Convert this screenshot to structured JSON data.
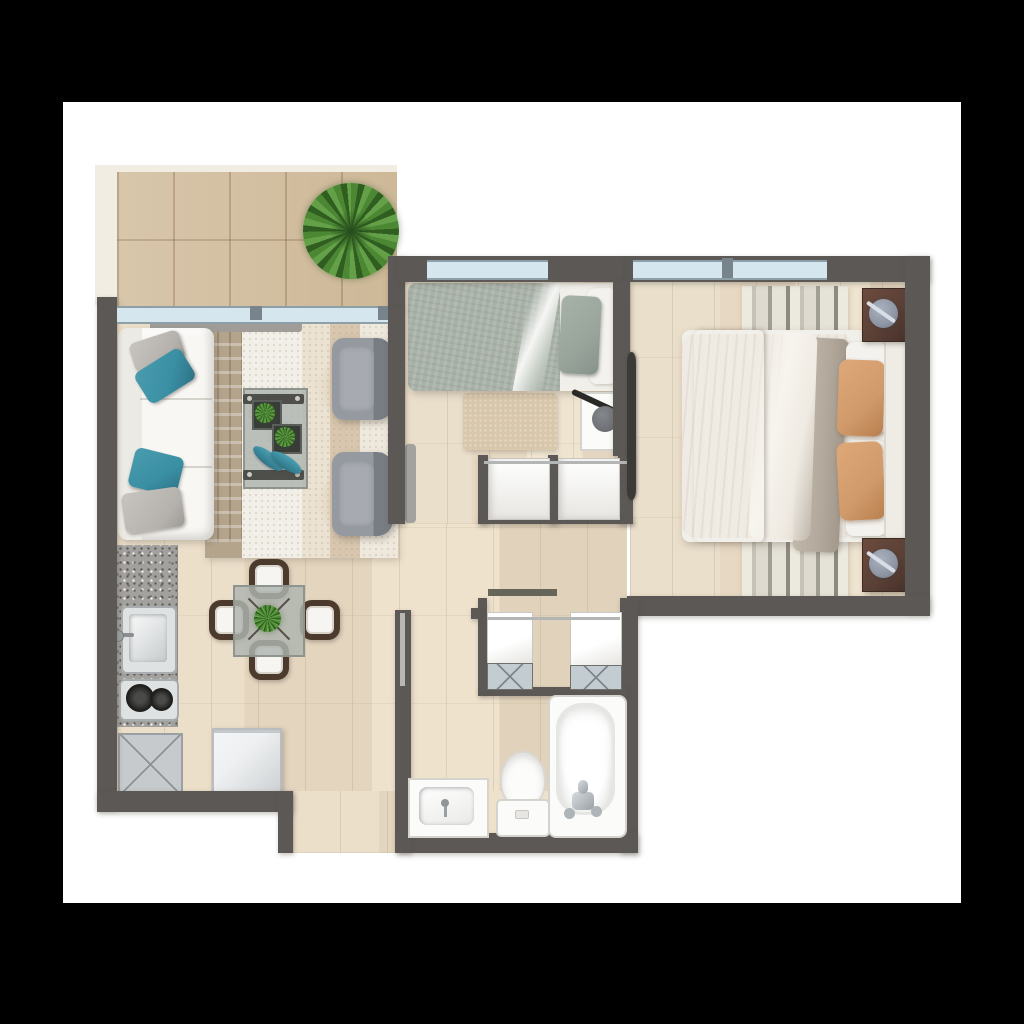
{
  "document": {
    "type": "apartment floor plan rendering",
    "description": "Top-down rendered floor plan of a two-bedroom apartment with balcony, shown on a white sheet over a black background"
  },
  "palette": {
    "page_bg": "#000000",
    "sheet": "#ffffff",
    "wall": "#5b5855",
    "balcony_border": "#f2ede2",
    "balcony_tile": "#d3c0a4",
    "wood_light": "#e8dcc6",
    "window_glass": "#d6e6ee",
    "window_frame": "#8da0a8",
    "sofa": "#f8f7f4",
    "teal": "#3a8fa3",
    "pillow_gray": "#b5b1ad",
    "armchair": "#787c83",
    "rug_knit": "#f2efe8",
    "rug_runner": "#b5a48c",
    "rug_band_tan": "#d8c6ae",
    "table_bar": "#4e4e4a",
    "glass": "rgba(175,180,176,0.82)",
    "plant": "#4c8733",
    "plant_dark": "#2f5e20",
    "sage": "#a9b2a9",
    "sheet_white": "#f4f2ee",
    "master_duvet": "#efeae2",
    "throw_brown": "#8b7260",
    "orange": "#d09a6a",
    "drape": "#b3a99c",
    "nightstand_wood": "#5a4036",
    "lamp": "#8e96a4",
    "rug_m_light": "#eceadf",
    "rug_m_dark": "#8f8a80",
    "granite": "#a3a19d",
    "burner": "#242422",
    "appliance": "#c6cacc",
    "fridge": "#eef0f1",
    "chair_wood": "#4c3a2d",
    "seat_white": "#f6f5f1",
    "fixture": "#fbfbfa",
    "closet_front": "#c3ccd1",
    "closet_x": "#7f868b",
    "shelf": "#66655a",
    "leaf_dark": "#3b3a37",
    "leaf_light": "#b9b7b2"
  },
  "rooms": {
    "balcony": {
      "name": "Balcony terrace",
      "furniture": [
        "potted plant"
      ]
    },
    "living": {
      "name": "Living room",
      "furniture": [
        "white sofa",
        "teal pillows",
        "gray pillows",
        "coffee table",
        "planter boxes",
        "two gray armchairs",
        "layered area rugs"
      ]
    },
    "dining": {
      "name": "Dining area",
      "furniture": [
        "glass dining table",
        "four wood chairs",
        "centerpiece plant"
      ]
    },
    "kitchen": {
      "name": "Kitchen",
      "furniture": [
        "granite counter",
        "sink",
        "two-burner cooktop",
        "appliance cabinet",
        "refrigerator"
      ]
    },
    "bedroom2": {
      "name": "Bedroom 2",
      "furniture": [
        "single bed with sage bedding",
        "nightstand with lamp",
        "beige rug",
        "two closets"
      ]
    },
    "master": {
      "name": "Master bedroom",
      "furniture": [
        "double bed",
        "brown throw",
        "orange pillows",
        "striped rug",
        "two dark wood nightstands with lamps",
        "door"
      ]
    },
    "hallway": {
      "name": "Hallway",
      "furniture": [
        "linen closets"
      ]
    },
    "bathroom": {
      "name": "Bathroom",
      "furniture": [
        "vanity sink",
        "toilet",
        "bathtub"
      ]
    },
    "entry": {
      "name": "Entry",
      "furniture": []
    }
  }
}
